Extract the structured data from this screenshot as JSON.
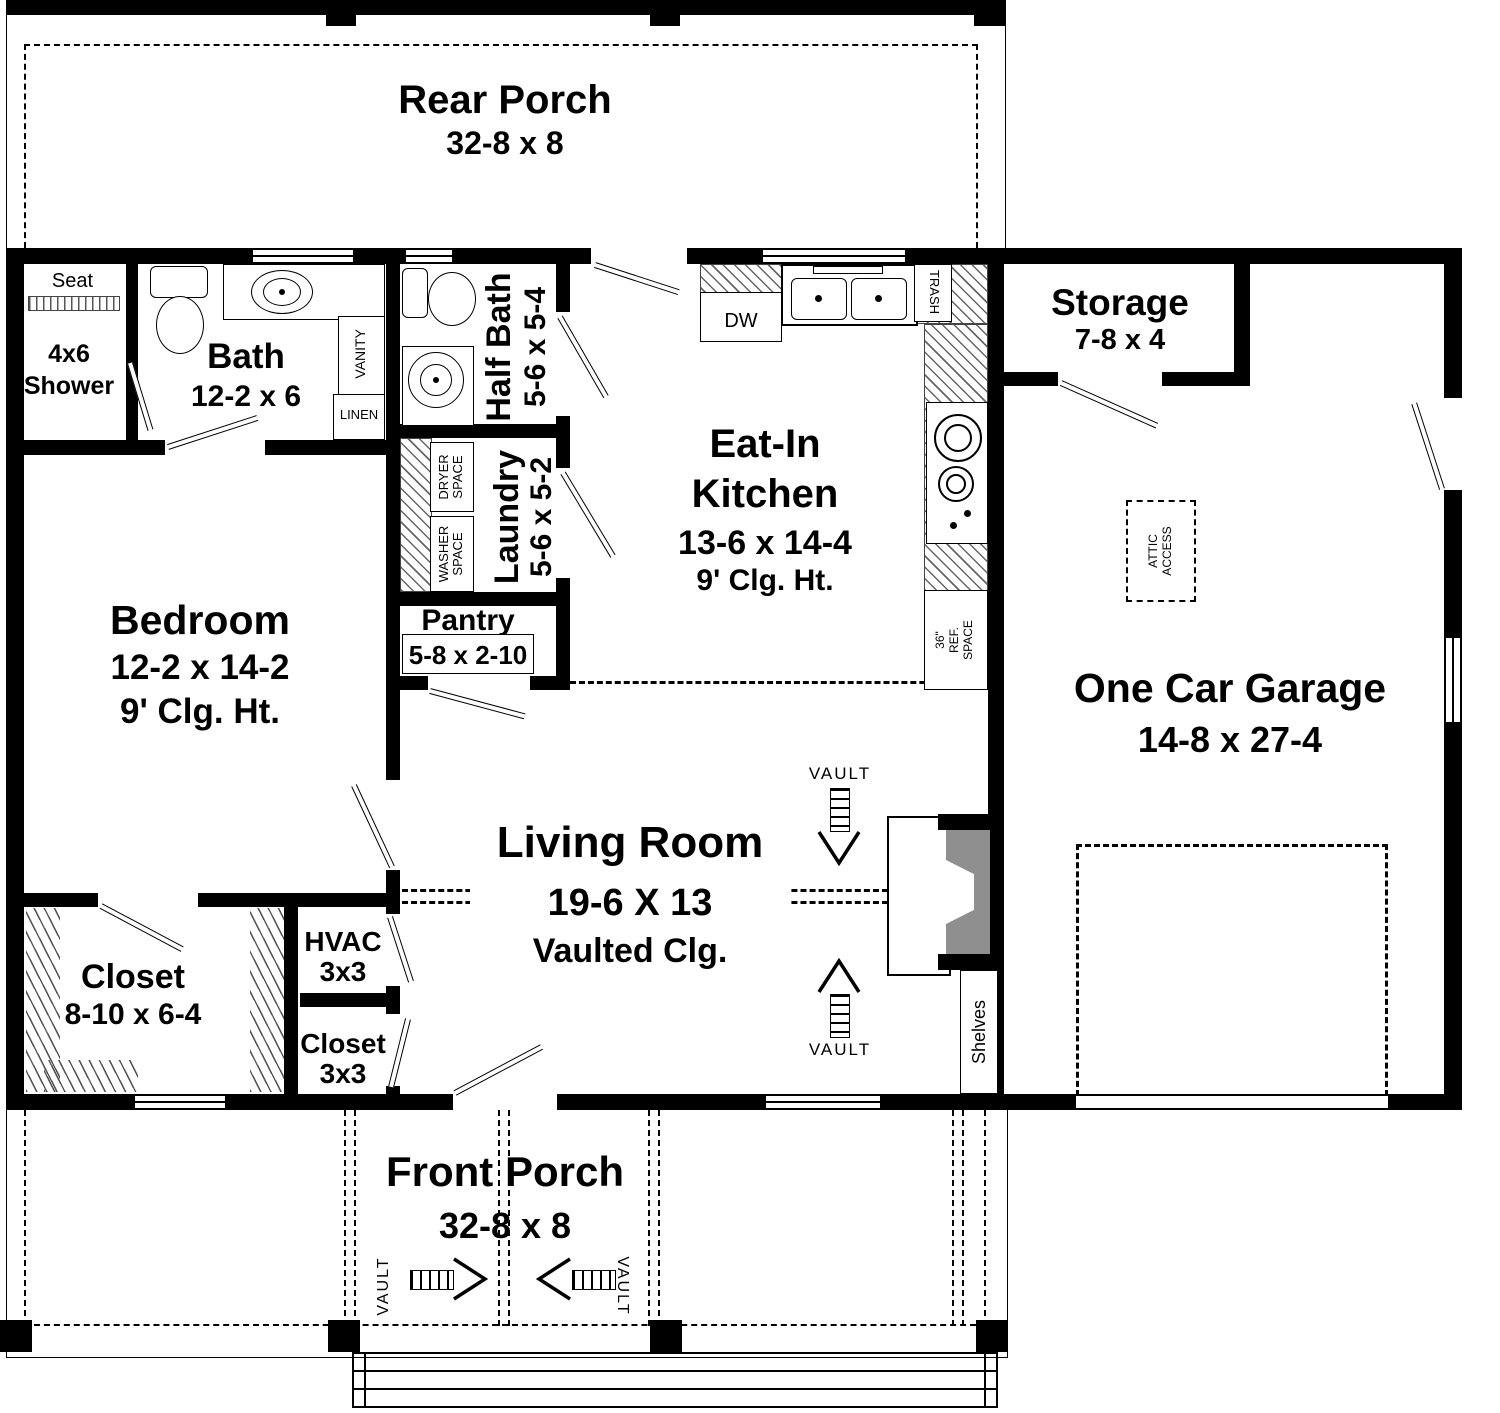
{
  "rear_porch": {
    "name": "Rear Porch",
    "dims": "32-8 x 8"
  },
  "front_porch": {
    "name": "Front Porch",
    "dims": "32-8 x 8",
    "vault": "VAULT"
  },
  "bath": {
    "name": "Bath",
    "dims": "12-2 x 6",
    "seat": "Seat",
    "shower": [
      "4x6",
      "Shower"
    ],
    "vanity": "VANITY",
    "linen": "LINEN"
  },
  "half_bath": {
    "name": "Half Bath",
    "dims": "5-6 x 5-4"
  },
  "laundry": {
    "name": "Laundry",
    "dims": "5-6 x 5-2",
    "dryer": [
      "DRYER",
      "SPACE"
    ],
    "washer": [
      "WASHER",
      "SPACE"
    ]
  },
  "pantry": {
    "name": "Pantry",
    "dims": "5-8 x 2-10"
  },
  "kitchen": {
    "name": [
      "Eat-In",
      "Kitchen"
    ],
    "dims": "13-6 x 14-4",
    "ceiling": "9' Clg. Ht.",
    "dw": "DW",
    "trash": "TRASH",
    "ref": [
      "36\"",
      "REF.",
      "SPACE"
    ]
  },
  "storage": {
    "name": "Storage",
    "dims": "7-8 x 4"
  },
  "garage": {
    "name": "One Car Garage",
    "dims": "14-8 x 27-4",
    "attic": [
      "ATTIC",
      "ACCESS"
    ],
    "shelves": "Shelves"
  },
  "bedroom": {
    "name": "Bedroom",
    "dims": "12-2 x 14-2",
    "ceiling": "9' Clg. Ht."
  },
  "living": {
    "name": "Living Room",
    "dims": "19-6 X 13",
    "ceiling": "Vaulted Clg.",
    "vault": "VAULT"
  },
  "closet": {
    "name": "Closet",
    "dims": "8-10 x 6-4"
  },
  "hvac": {
    "name": "HVAC",
    "dims": "3x3"
  },
  "closet2": {
    "name": "Closet",
    "dims": "3x3"
  },
  "colors": {
    "wall": "#000000",
    "fireplace": "#8f8f8f",
    "background": "#ffffff"
  }
}
